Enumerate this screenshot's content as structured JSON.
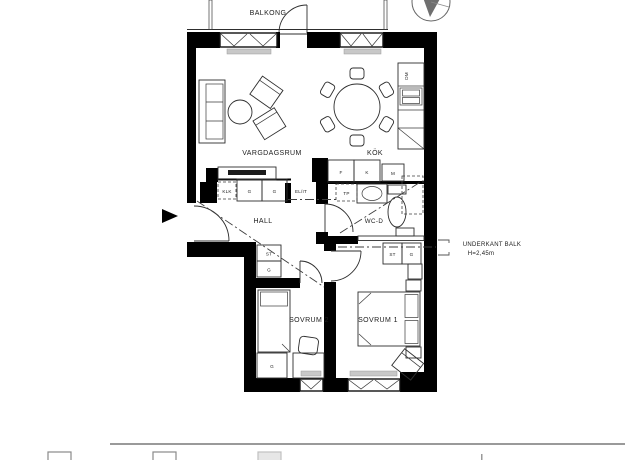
{
  "rooms": {
    "balcony": "BALKONG",
    "living": "VARGDAGSRUM",
    "kitchen": "KÖK",
    "hall": "HALL",
    "wc": "WC-D",
    "bedroom2": "SOVRUM 2",
    "bedroom1": "SOVRUM 1"
  },
  "beam_note": {
    "line1": "UNDERKANT BALK",
    "line2": "H=2,45m"
  },
  "hall_labels": {
    "wardrobe1": "G",
    "wardrobe2": "G",
    "closet_dashed": "KLK",
    "el_it": "EL/IT",
    "stack_top": "ST",
    "stack_bottom": "G"
  },
  "kitchen_labels": {
    "f": "F",
    "k": "K",
    "m": "M",
    "dm": "DM"
  },
  "wc_labels": {
    "tp": "TP"
  },
  "bedroom1_labels": {
    "cab1": "ST",
    "cab2": "G"
  },
  "bedroom2_labels": {
    "wardrobe": "G"
  },
  "colors": {
    "wall": "#000000",
    "furniture_line": "#2e2e2e",
    "beam_dash_line": "#3d3d3d",
    "radiator_fill": "#c8c8c8",
    "legend_rule": "#9a9a9a"
  }
}
